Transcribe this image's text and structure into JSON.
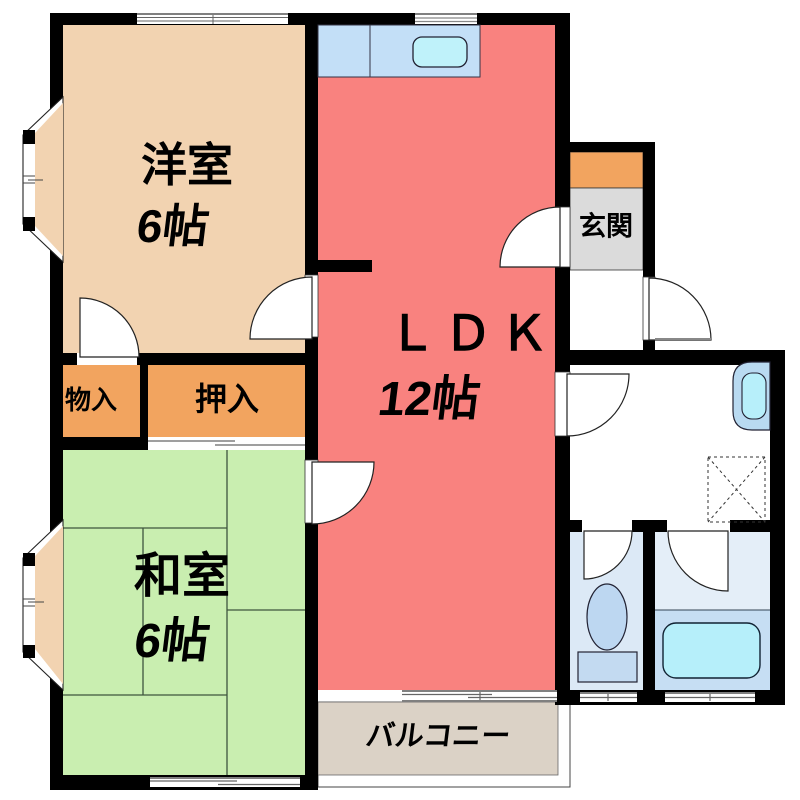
{
  "rooms": {
    "western": {
      "label": "洋室",
      "size": "6帖"
    },
    "ldk": {
      "label": "ＬＤＫ",
      "size": "12帖"
    },
    "japanese": {
      "label": "和室",
      "size": "6帖"
    },
    "storage": {
      "label": "物入"
    },
    "closet": {
      "label": "押入"
    },
    "entrance": {
      "label": "玄関"
    },
    "balcony": {
      "label": "バルコニー"
    }
  },
  "colors": {
    "wall": "#000000",
    "western_room": "#F2D3B1",
    "ldk": "#F9827F",
    "japanese_room": "#C9EEB0",
    "storage": "#F2A45F",
    "entrance_cabinet": "#F2A45F",
    "entrance_floor": "#DBDBDB",
    "kitchen_counter": "#C3DFF7",
    "kitchen_sink": "#BFF2FA",
    "balcony": "#DBD2C6",
    "toilet_floor": "#DCE9F6",
    "bath_floor_upper": "#E4EEF8",
    "bath_floor_lower": "#C6DEF3",
    "bathtub": "#B6EFFA",
    "washbasin_outer": "#B9DAF1",
    "washbasin_inner": "#B7EFFA",
    "toilet_fixture": "#BDD7F1",
    "toilet_tank": "#C3DAF1",
    "tatami_line": "#3E553E"
  }
}
